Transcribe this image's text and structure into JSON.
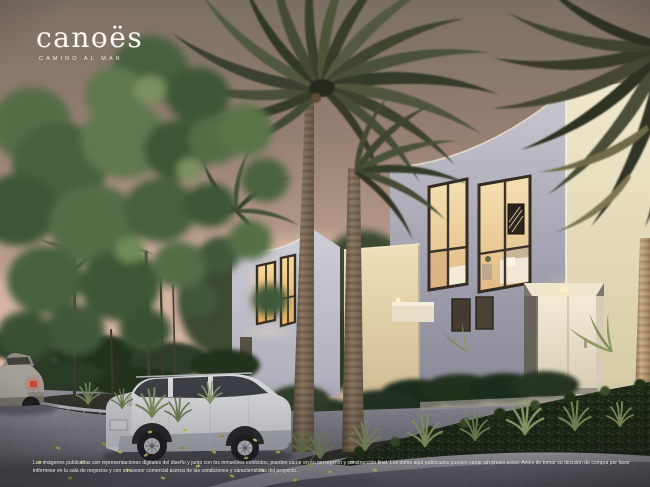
{
  "brand": {
    "wordmark_part1": "can",
    "wordmark_part2": "o",
    "wordmark_part3": "ës",
    "tagline": "CAMINO AL MAR"
  },
  "disclaimer": {
    "line1": "Las imágenes publicadas son representaciones digitales del diseño y junto con los inmuebles exhibidos, pueden variar en su percepción y construcción final. Los datos aquí publicados pueden variar sin previo aviso. Antes de tomar su decisión de compra por favor",
    "line2": "infórmese en la sala de negocios y con su asesor comercial acerca de las condiciones y características del proyecto."
  },
  "scene": {
    "elements": [
      "dusk-sky",
      "modern-house-left",
      "modern-house-right",
      "lit-bedroom-windows",
      "lit-entry-door",
      "palm-trees",
      "green-tree",
      "privacy-hedge",
      "white-suv",
      "gray-car",
      "paved-street",
      "planter-islands",
      "garden-wall-bollard",
      "street-lamp",
      "fallen-leaves"
    ]
  },
  "colors": {
    "sky_top": "#7b6f64",
    "sky_horizon": "#dcbca9",
    "house_wall": "#bcbbc6",
    "lit_panel": "#ecdfc0",
    "window_glow": "#f2d49e",
    "foliage_green": "#4d6341",
    "hedge_dark": "#1d2817",
    "pavement": "#85848b",
    "logo_white": "#fbfaf6",
    "taillight_red": "#c74638"
  },
  "icons": {
    "logo_o_emblem": "canoe-wave-inside-o"
  }
}
